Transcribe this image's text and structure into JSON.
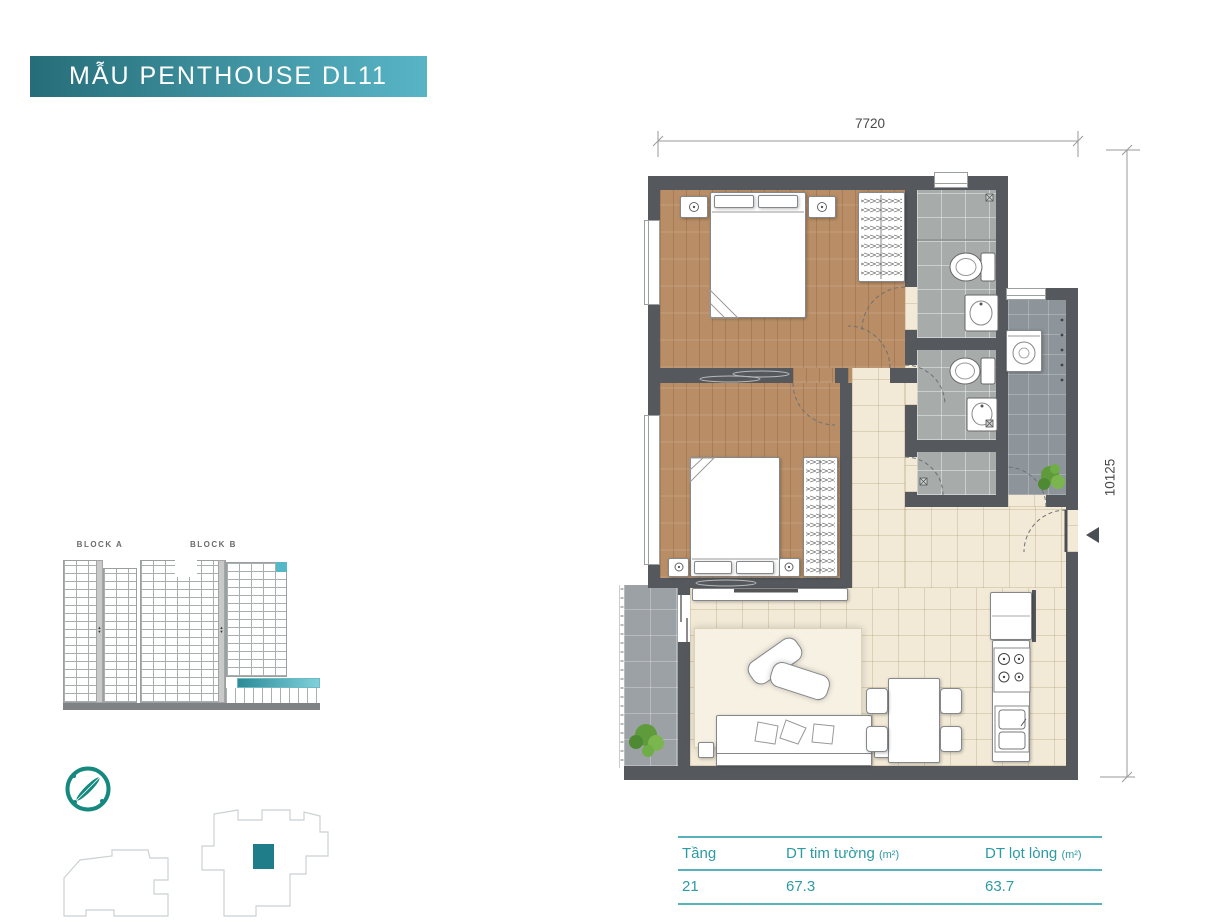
{
  "title": "MẪU PENTHOUSE DL11",
  "plan": {
    "width_label": "7720",
    "height_label": "10125"
  },
  "blocks": {
    "a": "BLOCK A",
    "b": "BLOCK B"
  },
  "table": {
    "columns": [
      {
        "label": "Tầng",
        "unit": ""
      },
      {
        "label": "DT tim tường",
        "unit": "(m²)"
      },
      {
        "label": "DT lọt lòng",
        "unit": "(m²)"
      }
    ],
    "row": {
      "floor": "21",
      "gross": "67.3",
      "net": "63.7"
    }
  },
  "icons": {
    "compass": "compass-rose-icon",
    "entry_marker": "entry-arrow-icon",
    "highlight_unit": "selected-unit-marker"
  },
  "colors": {
    "banner-start": "#266d79",
    "banner-end": "#58b5c6",
    "accent": "#2d9aa4",
    "accent-line": "#57b2ba",
    "highlight": "#56b7c8",
    "teal-dark": "#1e7d89",
    "teal-ring": "#15897f",
    "wall": "#55595d",
    "wood": "#b98e66",
    "beige": "#f2ead7",
    "bath": "#a7acaa",
    "util": "#8e959a",
    "balcony": "#9ba1a4",
    "dim-line": "#9a9a9a",
    "dim-text": "#4a4a4a",
    "block-base": "#7e8285"
  }
}
